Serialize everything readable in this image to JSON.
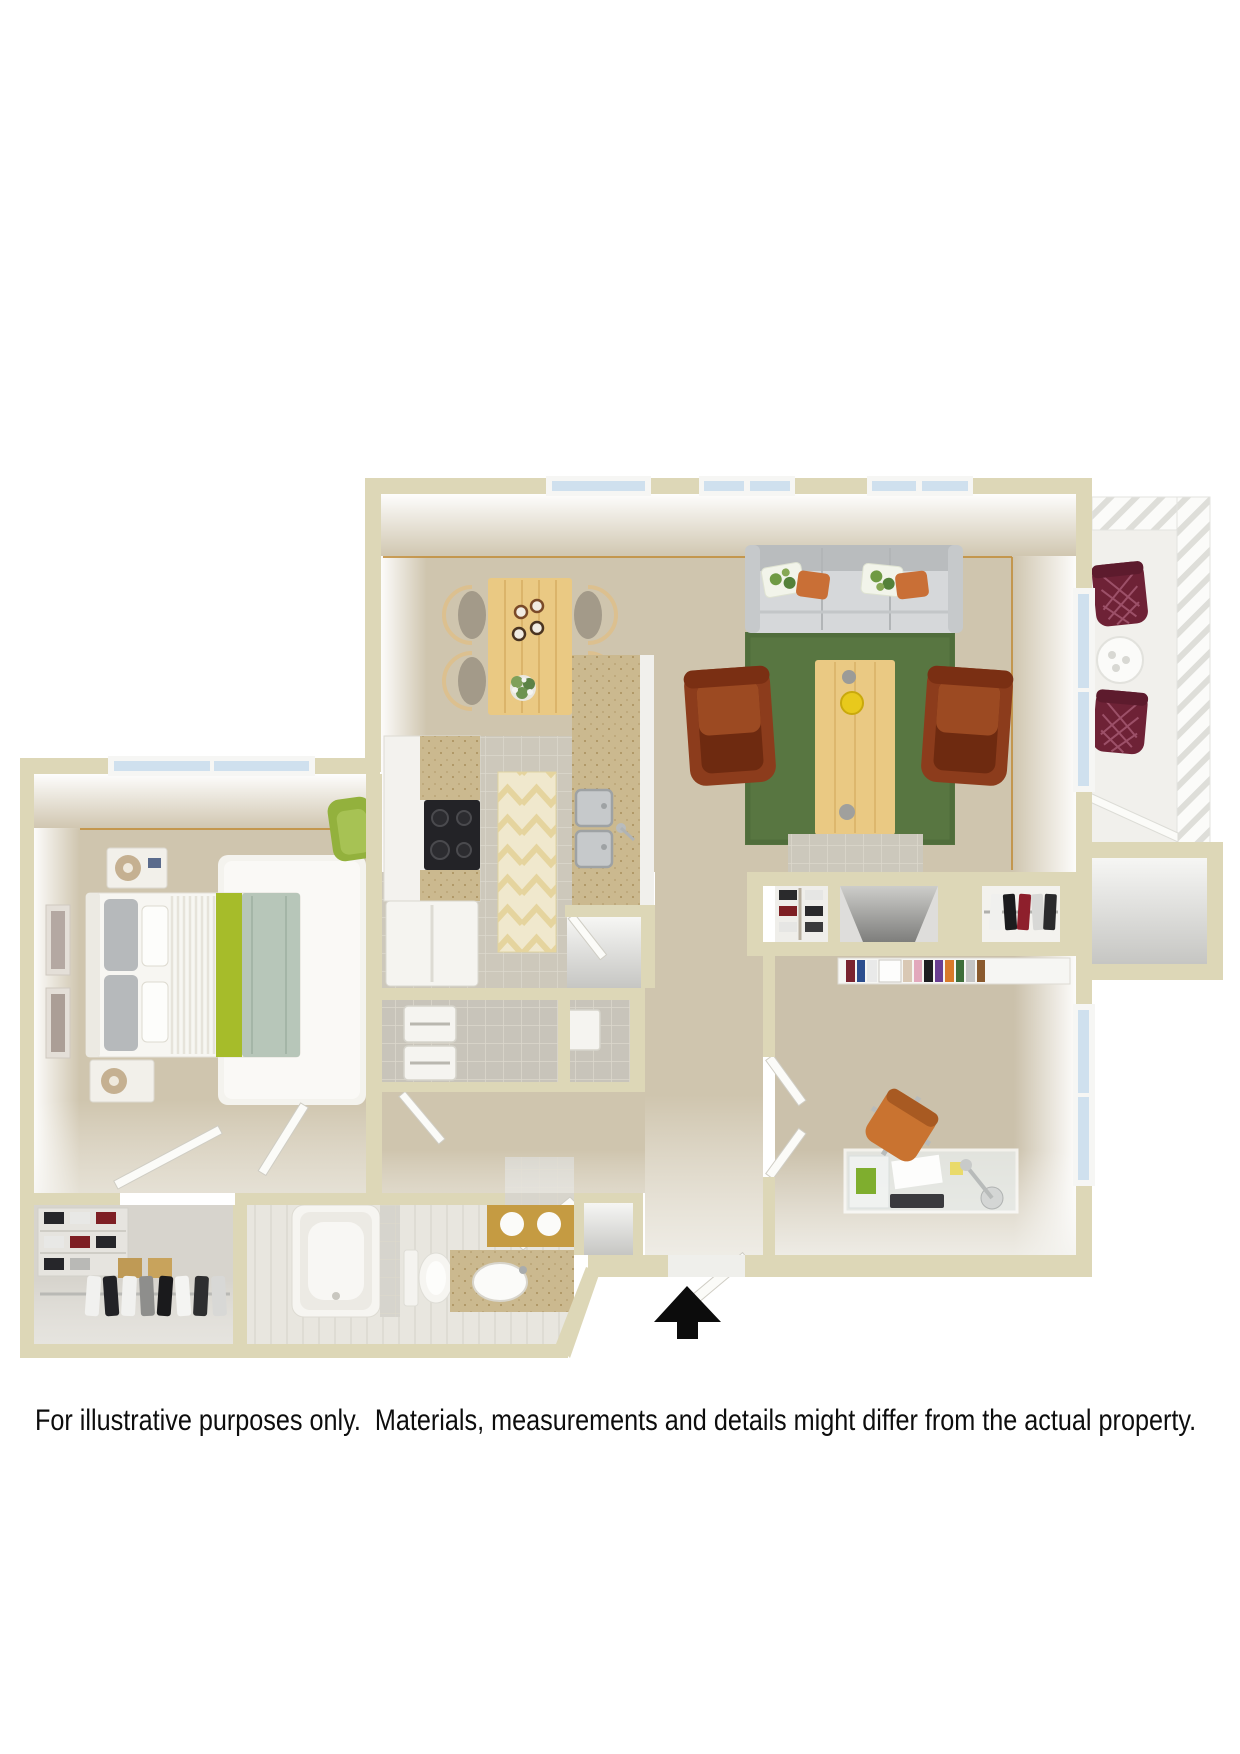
{
  "disclaimer": "For illustrative purposes only.  Materials, measurements and details might differ from the actual property.",
  "icons": {
    "entrance_arrow": "black-up-arrow"
  },
  "colors": {
    "page_bg": "#ffffff",
    "wall": "#ddd7b7",
    "carpet": "#cfc5ae",
    "carpet_dark": "#c0b49a",
    "tile": "#cdc8bb",
    "tile_line": "#dcd8cc",
    "bath_floor": "#e8e6df",
    "closet_floor": "#d7d4cd",
    "white_floor": "#f1f0ec",
    "trim": "#c28f3e",
    "glass": "#cfe0ee",
    "frame_white": "#f6f6f4",
    "rug_green": "#587641",
    "rug_white": "#f4f3ee",
    "sofa": "#d6d8da",
    "sofa_dark": "#b9bcbe",
    "leather": "#8c3c1c",
    "leather_dark": "#6e2a10",
    "wood": "#eac983",
    "wood_line": "#d4ab5f",
    "counter_tan": "#cbb98f",
    "cooktop": "#232327",
    "steel": "#c6c9cb",
    "balcony_chair": "#6e2236",
    "office_chair": "#c97330",
    "throw_green": "#a6bc2a",
    "blanket_sage": "#b7c6b9",
    "pillow_gray": "#b6b9bb",
    "gold_tile": "#c59b42",
    "lamp_tan": "#c5b091",
    "chair_green": "#93b13d",
    "runner_cream": "#f0e8cd",
    "arrow_black": "#0c0c0c"
  },
  "rooms": [
    {
      "name": "dining-area",
      "items": [
        "dining-table",
        "dining-chairs",
        "table-plant",
        "cups",
        "window"
      ]
    },
    {
      "name": "living-room",
      "items": [
        "sofa",
        "throw-pillows",
        "green-area-rug",
        "leather-armchair-left",
        "leather-armchair-right",
        "coffee-table",
        "fruit-bowl",
        "entry-tile",
        "skylight-windows",
        "balcony-window"
      ]
    },
    {
      "name": "balcony",
      "items": [
        "patio-chair-top",
        "patio-chair-bottom",
        "patio-table",
        "railing",
        "sliding-door"
      ]
    },
    {
      "name": "patio-storage",
      "items": []
    },
    {
      "name": "kitchen",
      "items": [
        "cabinets",
        "cooktop",
        "refrigerator",
        "double-sink",
        "counter",
        "runner-rug",
        "pantry"
      ]
    },
    {
      "name": "laundry-closet",
      "items": [
        "washer",
        "dryer"
      ]
    },
    {
      "name": "bedroom",
      "items": [
        "bed",
        "headboard",
        "pillows",
        "green-throw",
        "sage-blanket",
        "nightstand-top",
        "nightstand-bottom",
        "table-lamps",
        "white-shag-rug",
        "accent-chair",
        "wall-art",
        "window",
        "closet-door",
        "entry-door"
      ]
    },
    {
      "name": "hallway",
      "items": [
        "laundry-door",
        "bathroom-door"
      ]
    },
    {
      "name": "bathroom",
      "items": [
        "bathtub",
        "toilet",
        "vanity",
        "oval-sink",
        "gold-tile-shower"
      ]
    },
    {
      "name": "walk-in-closet",
      "items": [
        "shoe-shelves",
        "hanging-rod",
        "clothes",
        "storage-boxes"
      ]
    },
    {
      "name": "entry",
      "items": [
        "front-door",
        "entry-closet",
        "shoe-closet",
        "coat-closet",
        "mechanical-recess",
        "entrance-arrow"
      ]
    },
    {
      "name": "office",
      "items": [
        "bookshelf",
        "glass-desk",
        "office-chair",
        "desk-lamp",
        "keyboard",
        "double-doors",
        "window"
      ]
    }
  ]
}
